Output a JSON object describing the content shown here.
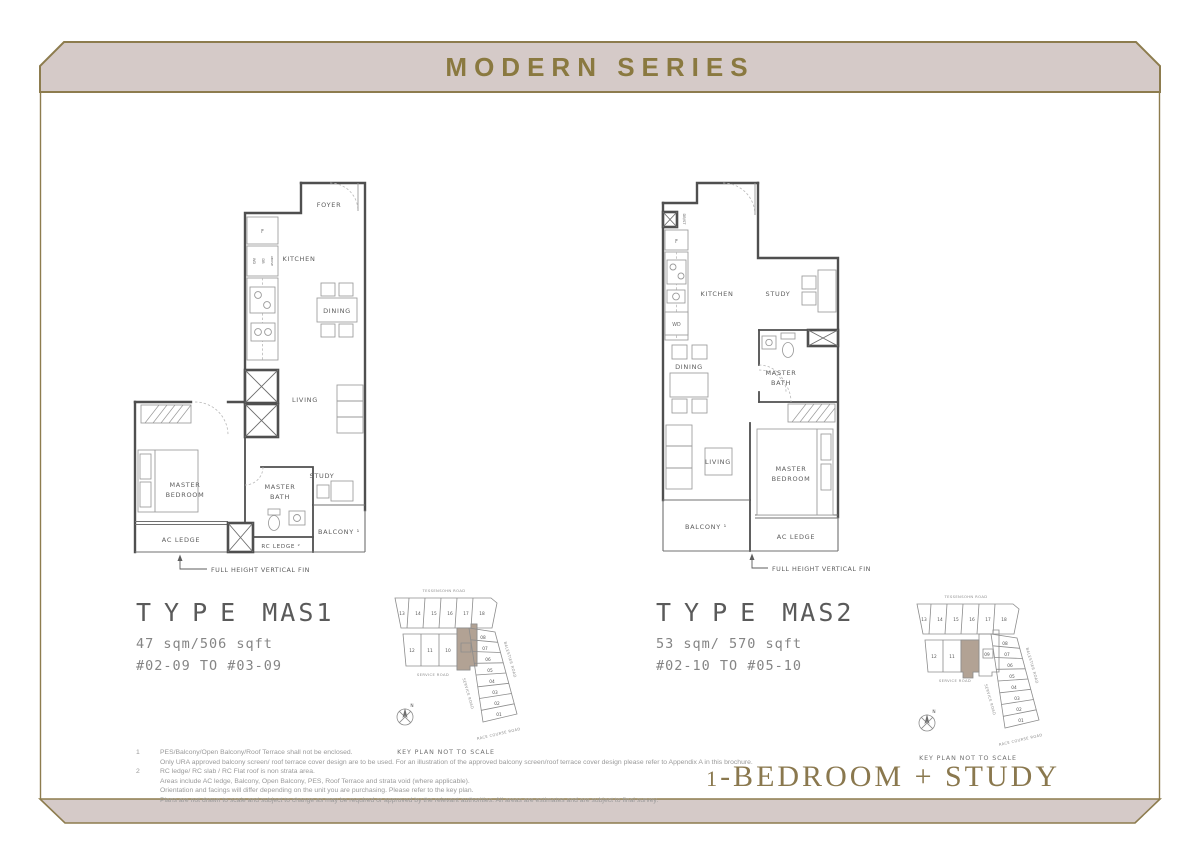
{
  "banner": {
    "title": "MODERN SERIES"
  },
  "category": {
    "num": "1",
    "rest": "-BEDROOM + STUDY"
  },
  "colors": {
    "gold": "#8d7c4e",
    "band": "#d5cac8",
    "wall": "#4f4f4f",
    "highlight": "#b2a294"
  },
  "plans": [
    {
      "type_word": "TYPE",
      "type_code": "MAS1",
      "area": "47 sqm/506 sqft",
      "units": "#02-09 TO #03-09",
      "labels": {
        "foyer": "FOYER",
        "kitchen": "KITCHEN",
        "dining": "DINING",
        "living": "LIVING",
        "study": "STUDY",
        "mbr1": "MASTER",
        "mbr2": "BEDROOM",
        "mb1": "MASTER",
        "mb2": "BATH",
        "ac_ledge": "AC LEDGE",
        "rc_ledge": "RC LEDGE ²",
        "balcony": "BALCONY ¹",
        "fridge": "F",
        "wd": "WD",
        "db": "DB",
        "above": "ABOVE",
        "fin": "FULL HEIGHT VERTICAL FIN"
      }
    },
    {
      "type_word": "TYPE",
      "type_code": "MAS2",
      "area": "53 sqm/ 570 sqft",
      "units": "#02-10 TO #05-10",
      "labels": {
        "kitchen": "KITCHEN",
        "study": "STUDY",
        "dining": "DINING",
        "living": "LIVING",
        "mbr1": "MASTER",
        "mbr2": "BEDROOM",
        "mb1": "MASTER",
        "mb2": "BATH",
        "ac_ledge": "AC LEDGE",
        "balcony": "BALCONY ¹",
        "fridge": "F",
        "wd": "WD",
        "dbst": "DB/ST",
        "fin": "FULL HEIGHT VERTICAL FIN"
      }
    }
  ],
  "keyplans": [
    {
      "caption": "KEY PLAN NOT TO SCALE",
      "north": "N",
      "roads": {
        "top": "TESSENSOHN ROAD",
        "service": "SERVICE ROAD",
        "service_diag": "SERVICE ROAD",
        "right": "BALESTIER ROAD",
        "bottom": "RACE COURSE ROAD"
      },
      "top_units": [
        "13",
        "14",
        "15",
        "16",
        "17",
        "18"
      ],
      "mid_units": [
        "12",
        "11",
        "10",
        ""
      ],
      "col_units": [
        "08",
        "07",
        "06",
        "05",
        "04",
        "03",
        "02",
        "01"
      ],
      "highlighted_unit": "09"
    },
    {
      "caption": "KEY PLAN NOT TO SCALE",
      "north": "N",
      "roads": {
        "top": "TESSENSOHN ROAD",
        "service": "SERVICE ROAD",
        "service_diag": "SERVICE ROAD",
        "right": "BALESTIER ROAD",
        "bottom": "RACE COURSE ROAD"
      },
      "top_units": [
        "13",
        "14",
        "15",
        "16",
        "17",
        "18"
      ],
      "mid_units": [
        "12",
        "11",
        "",
        "09"
      ],
      "col_units": [
        "08",
        "07",
        "06",
        "05",
        "04",
        "03",
        "02",
        "01"
      ],
      "highlighted_unit": "10"
    }
  ],
  "footnotes": [
    {
      "num": "1",
      "lines": [
        "PES/Balcony/Open Balcony/Roof Terrace shall not be enclosed.",
        "Only URA approved balcony screen/ roof terrace cover design are to be used. For an illustration of the approved balcony screen/roof terrace cover design please refer to Appendix A in this brochure."
      ]
    },
    {
      "num": "2",
      "lines": [
        "RC ledge/ RC slab / RC Flat roof is non strata area.",
        "Areas include AC ledge, Balcony, Open Balcony, PES, Roof Terrace and strata void  (where applicable).",
        "Orientation and facings will differ depending on the unit you are purchasing. Please refer to the key plan.",
        "Plans are not drawn to scale and subject to change as may be required or approved by the relevant authorities. All areas are estimates and are subject to final survey."
      ]
    }
  ]
}
